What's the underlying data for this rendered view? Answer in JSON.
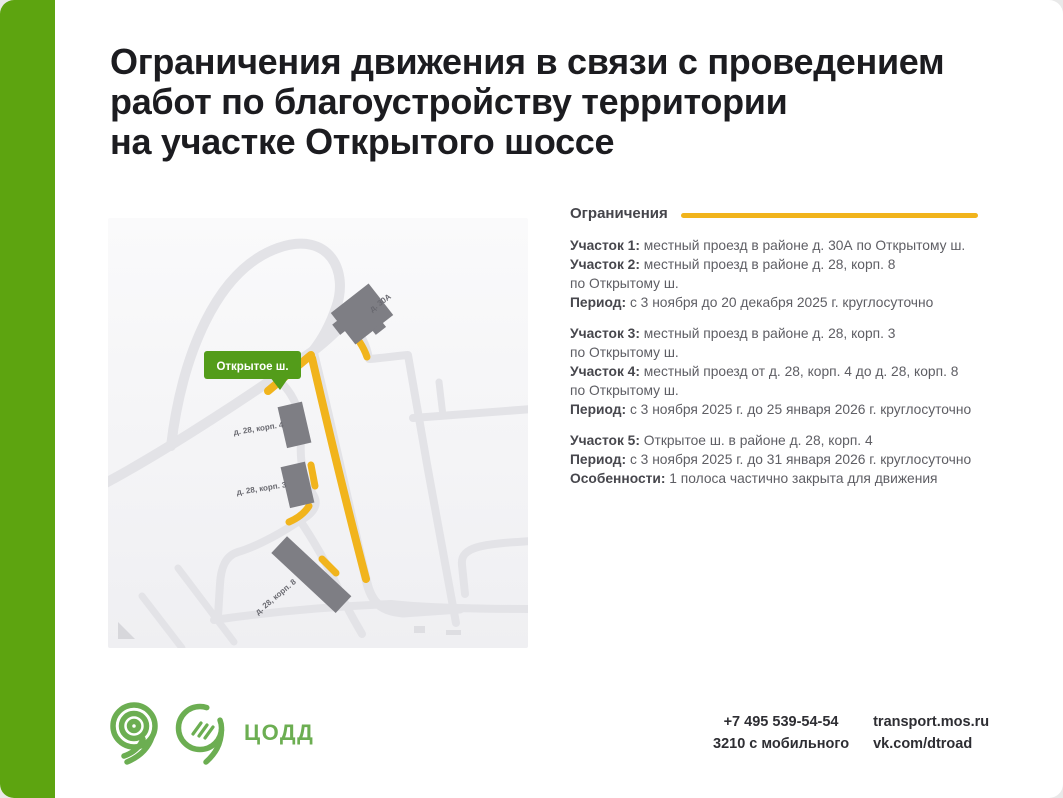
{
  "page": {
    "accent_bar_color": "#5da410",
    "background": "#ffffff"
  },
  "title": {
    "lines": [
      "Ограничения движения в связи с проведением",
      "работ по благоустройству территории",
      "на участке Открытого шоссе"
    ]
  },
  "map": {
    "road_label_badge": "Открытое ш.",
    "badge_color": "#539c1a",
    "building_labels": [
      "д. 30А",
      "д. 28, корп. 4",
      "д. 28, корп. 3",
      "д. 28, корп. 8"
    ],
    "restriction_highlight_color": "#f1b41c",
    "road_color": "#e3e3e7",
    "building_color": "#7e7e84"
  },
  "legend": {
    "header": "Ограничения",
    "line_color": "#f1b41c"
  },
  "restrictions": [
    {
      "items": [
        {
          "label": "Участок 1:",
          "text": "местный проезд в районе д. 30А по Открытому ш."
        },
        {
          "label": "Участок 2:",
          "text": "местный проезд в районе д. 28, корп. 8\nпо Открытому ш."
        },
        {
          "label": "Период:",
          "text": "с 3 ноября до 20 декабря 2025 г. круглосуточно"
        }
      ]
    },
    {
      "items": [
        {
          "label": "Участок 3:",
          "text": "местный проезд в районе д. 28, корп. 3\nпо Открытому ш."
        },
        {
          "label": "Участок 4:",
          "text": "местный проезд от д. 28, корп. 4 до д. 28, корп. 8\nпо Открытому ш."
        },
        {
          "label": "Период:",
          "text": "с 3 ноября 2025 г. до 25 января 2026 г. круглосуточно"
        }
      ]
    },
    {
      "items": [
        {
          "label": "Участок 5:",
          "text": "Открытое ш. в районе д. 28, корп. 4"
        },
        {
          "label": "Период:",
          "text": "с 3 ноября 2025 г. до 31 января 2026 г. круглосуточно"
        },
        {
          "label": "Особенности:",
          "text": "1 полоса частично закрыта для движения"
        }
      ]
    }
  ],
  "footer": {
    "org_name": "ЦОДД",
    "logo_color": "#6cae52",
    "phone_main": "+7 495 539-54-54",
    "phone_mobile": "3210 с мобильного",
    "website": "transport.mos.ru",
    "social": "vk.com/dtroad"
  }
}
